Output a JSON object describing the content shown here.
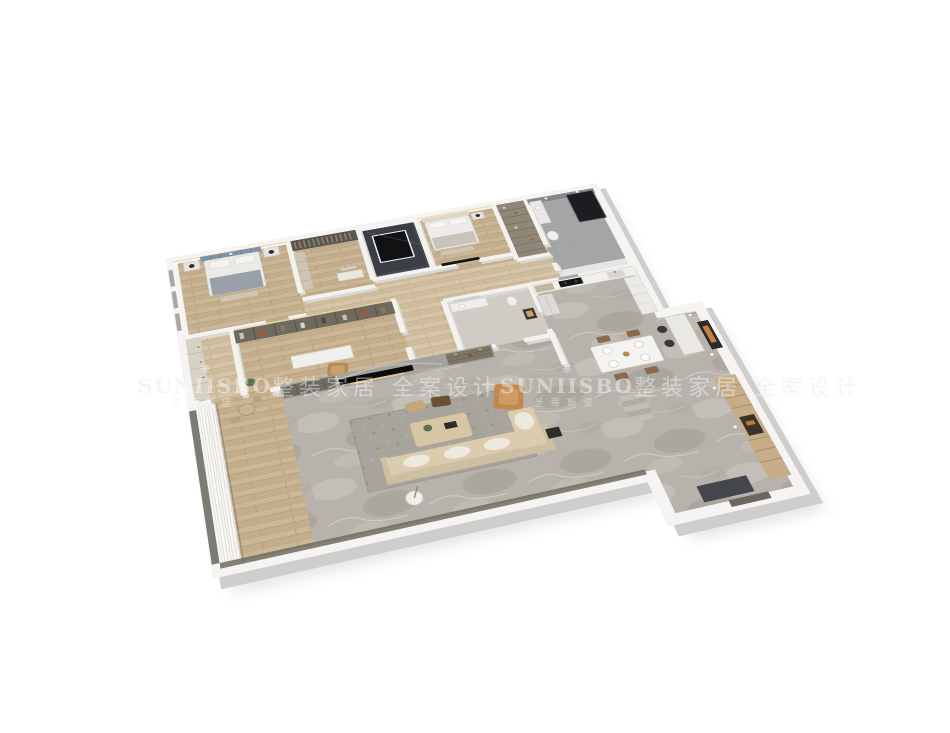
{
  "scene": {
    "description": "3D axonometric dollhouse render of a furnished apartment floor plan on a white background",
    "background_color": "#ffffff"
  },
  "watermark": {
    "icon": "petal-flourish-icon",
    "icon_glyph": "❋",
    "brand_latin": "SUNIISBO",
    "brand_chinese": "圣蒂斯堡",
    "tagline": "整装家居 全案设计",
    "color_over_background": "#efefee",
    "color_over_render": "rgba(255,255,255,0.42)"
  },
  "palette": {
    "outer_wall": "#f5f4f2",
    "wall_shadow": "#cfcecc",
    "wood_floor": "#cbb797",
    "marble_floor": "#b7b3ac",
    "rug": "#a7a39d",
    "dark_slate": "#474b51",
    "cabinet_olive": "#6f6a5d",
    "sofa_beige": "#dccbad",
    "leather_tan": "#c08950",
    "headboard_blue": "#7e93a7",
    "accent_orange": "#c8823d"
  },
  "rooms": [
    "master-bedroom",
    "walk-in-closet",
    "dark-utility-room",
    "bedroom-2",
    "shelf-closet",
    "bathroom-2",
    "hallway",
    "wardrobe-nook",
    "study",
    "center-bathroom",
    "kitchen",
    "dining-area",
    "living-room",
    "balcony",
    "entry-hall"
  ]
}
